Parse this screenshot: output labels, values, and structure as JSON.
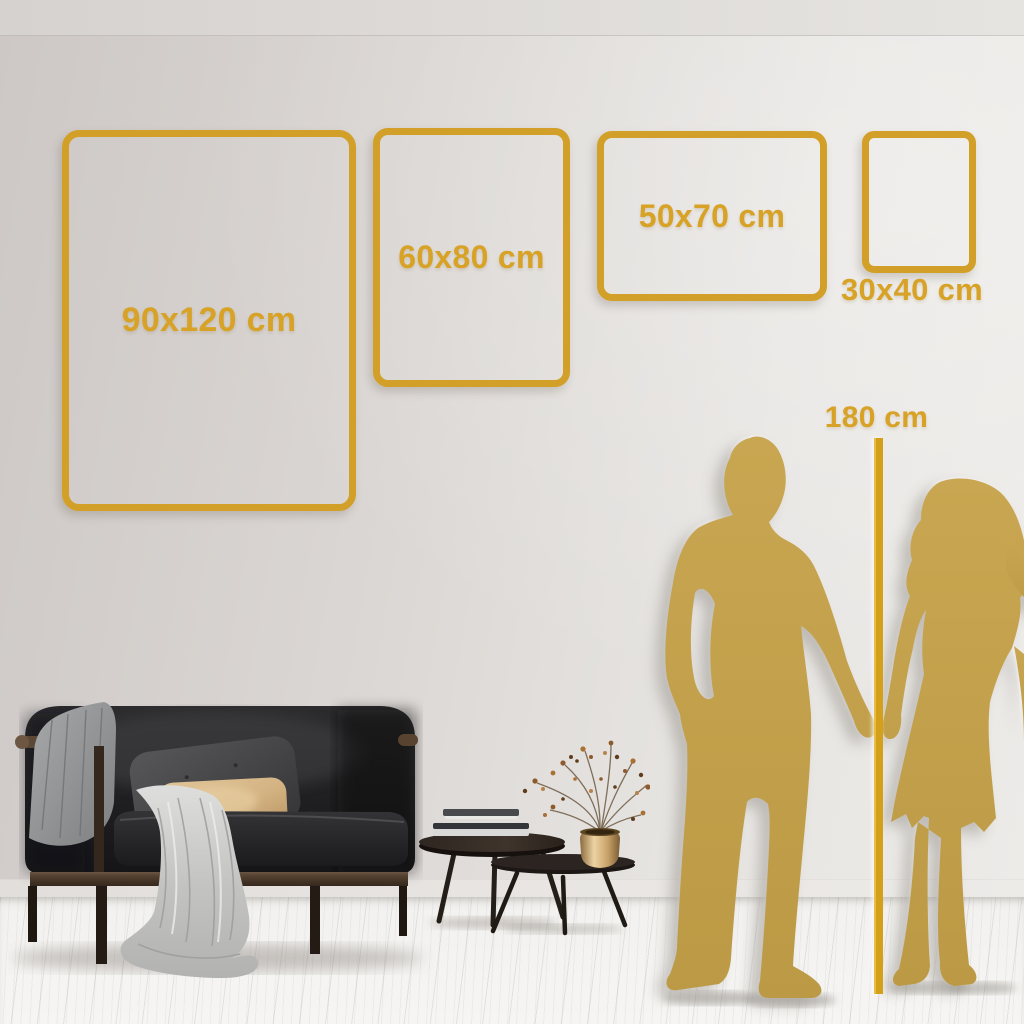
{
  "colors": {
    "accent_gold": "#D7A226",
    "frame_gold": "#D2A028",
    "line_gold": "#D4A01A",
    "silhouette_gold": "#C4A14C",
    "wall": "#DEDAD6",
    "floor": "#F4F3F1"
  },
  "size_guide": {
    "frames": [
      {
        "label": "90x120 cm",
        "width_cm": 90,
        "height_cm": 120,
        "orientation": "portrait"
      },
      {
        "label": "60x80 cm",
        "width_cm": 60,
        "height_cm": 80,
        "orientation": "portrait"
      },
      {
        "label": "50x70 cm",
        "width_cm": 50,
        "height_cm": 70,
        "orientation": "landscape"
      },
      {
        "label": "30x40 cm",
        "width_cm": 30,
        "height_cm": 40,
        "orientation": "portrait"
      }
    ],
    "height_marker": {
      "label": "180 cm",
      "height_cm": 180
    }
  },
  "scene": {
    "silhouettes": [
      {
        "name": "man-silhouette"
      },
      {
        "name": "woman-silhouette"
      }
    ],
    "furniture": [
      {
        "name": "sofa"
      },
      {
        "name": "nesting-coffee-tables"
      },
      {
        "name": "books"
      },
      {
        "name": "vase-with-dried-branches"
      }
    ]
  }
}
